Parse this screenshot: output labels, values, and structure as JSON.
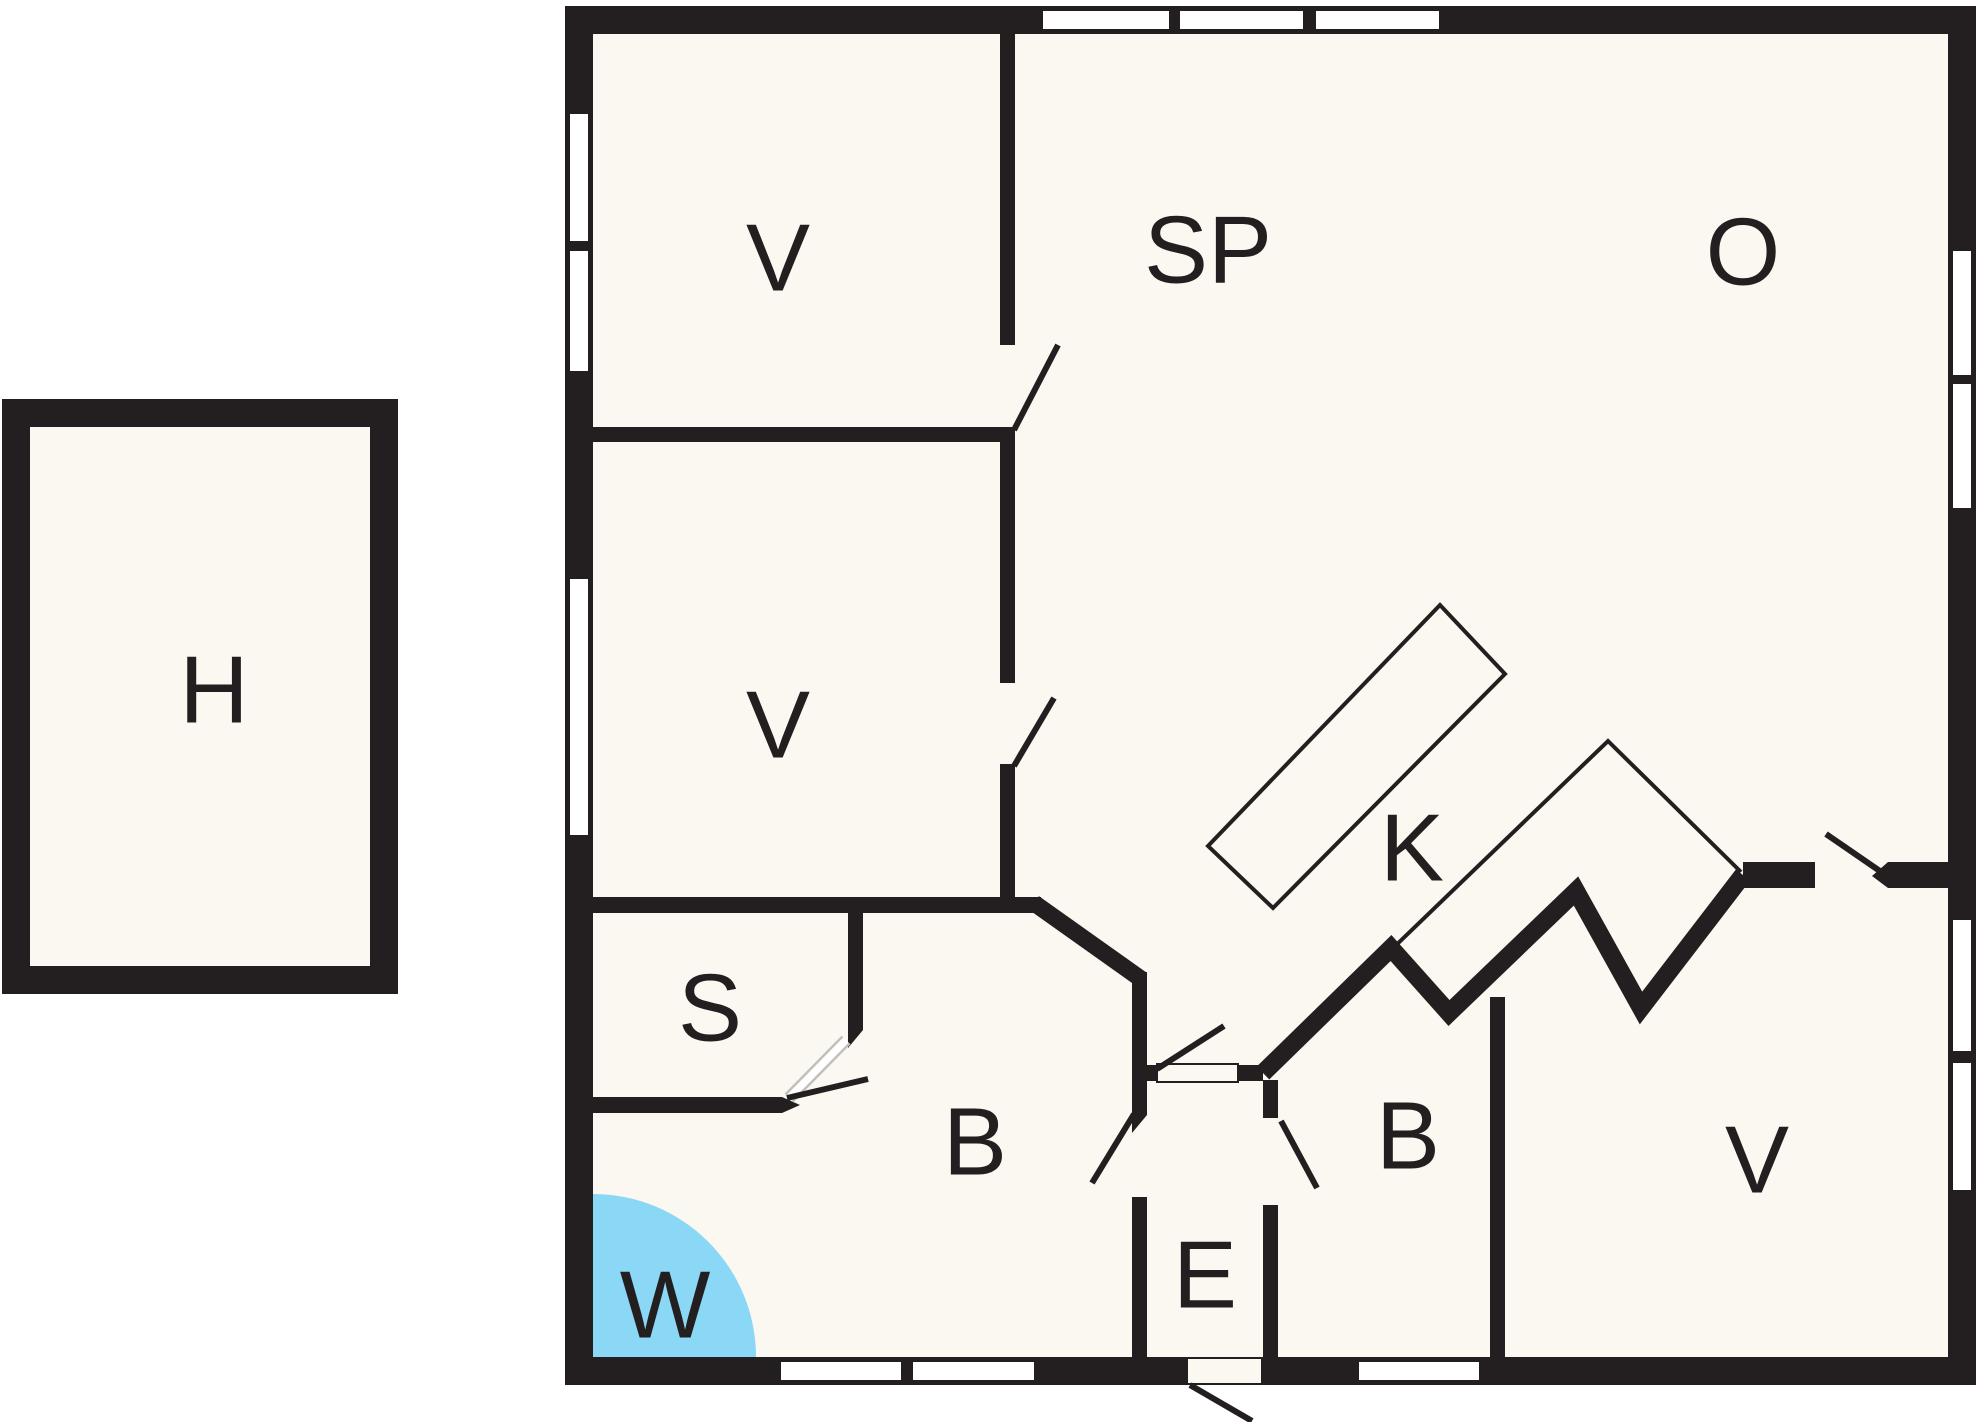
{
  "title": "floor-plan",
  "colors": {
    "wall": "#231f20",
    "floor": "#faf8f0",
    "page": "#ffffff",
    "water": "#8bd7f6",
    "thin_line": "#231f20",
    "panel_edge": "#c2c0ba"
  },
  "canvas": {
    "w": 1980,
    "h": 1422
  },
  "rooms": [
    {
      "id": "h",
      "label": "H",
      "x": 214,
      "y": 690
    },
    {
      "id": "v-top",
      "label": "V",
      "x": 778,
      "y": 258
    },
    {
      "id": "sp",
      "label": "SP",
      "x": 1208,
      "y": 250
    },
    {
      "id": "o",
      "label": "O",
      "x": 1743,
      "y": 252
    },
    {
      "id": "v-mid",
      "label": "V",
      "x": 778,
      "y": 725
    },
    {
      "id": "k",
      "label": "K",
      "x": 1412,
      "y": 848
    },
    {
      "id": "s",
      "label": "S",
      "x": 710,
      "y": 1008
    },
    {
      "id": "b-left",
      "label": "B",
      "x": 975,
      "y": 1142
    },
    {
      "id": "e",
      "label": "E",
      "x": 1205,
      "y": 1275
    },
    {
      "id": "b-right",
      "label": "B",
      "x": 1408,
      "y": 1136
    },
    {
      "id": "v-bottom",
      "label": "V",
      "x": 1757,
      "y": 1160
    },
    {
      "id": "w",
      "label": "W",
      "x": 665,
      "y": 1305
    }
  ],
  "plan": {
    "floors": [
      {
        "n": "annex-floor",
        "x": 2,
        "y": 399,
        "w": 396,
        "h": 595
      },
      {
        "n": "main-floor",
        "x": 565,
        "y": 6,
        "w": 1411,
        "h": 1379
      }
    ],
    "spa": {
      "cx": 593,
      "cy": 1357,
      "r": 163
    },
    "counters": {
      "island": "1208,846 1440,605 1505,674 1273,908",
      "run": "1391,950 1608,741 1741,872"
    },
    "walls_rects": [
      {
        "n": "annex-wall-top",
        "x": 2,
        "y": 399,
        "w": 396,
        "h": 28
      },
      {
        "n": "annex-wall-bottom",
        "x": 2,
        "y": 966,
        "w": 396,
        "h": 28
      },
      {
        "n": "annex-wall-left",
        "x": 2,
        "y": 399,
        "w": 28,
        "h": 595
      },
      {
        "n": "annex-wall-right",
        "x": 370,
        "y": 399,
        "w": 28,
        "h": 595
      },
      {
        "n": "main-wall-top",
        "x": 565,
        "y": 6,
        "w": 1411,
        "h": 28
      },
      {
        "n": "main-wall-bottom",
        "x": 565,
        "y": 1357,
        "w": 1411,
        "h": 28
      },
      {
        "n": "main-wall-left",
        "x": 565,
        "y": 6,
        "w": 28,
        "h": 1379
      },
      {
        "n": "main-wall-right",
        "x": 1948,
        "y": 6,
        "w": 28,
        "h": 1379
      },
      {
        "n": "wall-v-v-divider",
        "x": 593,
        "y": 427,
        "w": 422,
        "h": 15
      },
      {
        "n": "wall-divider-seg1",
        "x": 1000,
        "y": 34,
        "w": 15,
        "h": 311
      },
      {
        "n": "wall-divider-seg2",
        "x": 1000,
        "y": 428,
        "w": 15,
        "h": 255
      },
      {
        "n": "wall-divider-seg3",
        "x": 1000,
        "y": 764,
        "w": 15,
        "h": 149
      },
      {
        "n": "wall-s-top",
        "x": 593,
        "y": 897,
        "w": 448,
        "h": 16
      },
      {
        "n": "wall-e-left-seg1",
        "x": 1132,
        "y": 972,
        "w": 15,
        "h": 143
      },
      {
        "n": "wall-e-left-seg2",
        "x": 1132,
        "y": 1197,
        "w": 15,
        "h": 160
      },
      {
        "n": "wall-s-b-divider",
        "x": 848,
        "y": 913,
        "w": 15,
        "h": 117
      },
      {
        "n": "wall-s-bottom",
        "x": 593,
        "y": 1097,
        "w": 189,
        "h": 16
      },
      {
        "n": "wall-e-top-seg1",
        "x": 1147,
        "y": 1065,
        "w": 10,
        "h": 16
      },
      {
        "n": "wall-e-top-seg2",
        "x": 1238,
        "y": 1065,
        "w": 25,
        "h": 16
      },
      {
        "n": "wall-e-right-seg1",
        "x": 1263,
        "y": 1080,
        "w": 15,
        "h": 38
      },
      {
        "n": "wall-e-right-seg2",
        "x": 1263,
        "y": 1205,
        "w": 15,
        "h": 152
      },
      {
        "n": "wall-v-right-seg1",
        "x": 1743,
        "y": 862,
        "w": 72,
        "h": 26
      },
      {
        "n": "wall-v-right-seg2",
        "x": 1888,
        "y": 862,
        "w": 60,
        "h": 26
      },
      {
        "n": "wall-b-v-divider",
        "x": 1490,
        "y": 997,
        "w": 15,
        "h": 360
      }
    ],
    "walls_lines": [
      {
        "n": "wall-chamfer",
        "x1": 1034,
        "y1": 903,
        "x2": 1141,
        "y2": 979,
        "w": 17
      }
    ],
    "walls_zigzag": {
      "n": "wall-kitchen-zigzag",
      "points": "1263,1073 1391,948 1449,1013 1576,891 1641,1008 1743,875",
      "w": 18
    },
    "walls_polys": [
      {
        "n": "doorstop-s-divider",
        "points": "863,1030 848,1030 848,1048"
      },
      {
        "n": "doorstop-s-bottom",
        "points": "782,1097 800,1105 782,1113"
      },
      {
        "n": "doorstop-v-right",
        "points": "1888,862 1872,876 1888,888"
      },
      {
        "n": "doorstop-e-left",
        "points": "1132,1115 1147,1115 1132,1133"
      }
    ],
    "windows": [
      {
        "n": "window-left-1",
        "x": 569,
        "y": 113,
        "w": 20,
        "h": 129
      },
      {
        "n": "window-left-2",
        "x": 569,
        "y": 250,
        "w": 20,
        "h": 122
      },
      {
        "n": "window-left-3",
        "x": 569,
        "y": 578,
        "w": 20,
        "h": 258
      },
      {
        "n": "window-top-1",
        "x": 1042,
        "y": 10,
        "w": 128,
        "h": 20
      },
      {
        "n": "window-top-2",
        "x": 1179,
        "y": 10,
        "w": 125,
        "h": 20
      },
      {
        "n": "window-top-3",
        "x": 1315,
        "y": 10,
        "w": 125,
        "h": 20
      },
      {
        "n": "window-right-1",
        "x": 1952,
        "y": 250,
        "w": 20,
        "h": 126
      },
      {
        "n": "window-right-2",
        "x": 1952,
        "y": 383,
        "w": 20,
        "h": 126
      },
      {
        "n": "window-right-3",
        "x": 1952,
        "y": 919,
        "w": 20,
        "h": 133
      },
      {
        "n": "window-right-4",
        "x": 1952,
        "y": 1062,
        "w": 20,
        "h": 129
      },
      {
        "n": "window-bottom-1",
        "x": 780,
        "y": 1361,
        "w": 122,
        "h": 20
      },
      {
        "n": "window-bottom-2",
        "x": 912,
        "y": 1361,
        "w": 123,
        "h": 20
      },
      {
        "n": "window-bottom-3",
        "x": 1358,
        "y": 1361,
        "w": 122,
        "h": 20
      }
    ],
    "openings": [
      {
        "n": "opening-e-top",
        "x": 1157,
        "y": 1064,
        "w": 81,
        "h": 18
      },
      {
        "n": "opening-entry-door",
        "x": 1187,
        "y": 1358,
        "w": 75,
        "h": 26
      }
    ],
    "door_panel": {
      "n": "door-panel-s",
      "x1": 846,
      "y1": 1040,
      "x2": 789,
      "y2": 1098
    },
    "door_leaves": [
      {
        "n": "door-leaf-sp",
        "x1": 1014,
        "y1": 430,
        "x2": 1058,
        "y2": 345
      },
      {
        "n": "door-leaf-v-mid",
        "x1": 1014,
        "y1": 766,
        "x2": 1054,
        "y2": 698
      },
      {
        "n": "door-leaf-s",
        "x1": 787,
        "y1": 1098,
        "x2": 868,
        "y2": 1079
      },
      {
        "n": "door-leaf-b-left",
        "x1": 1134,
        "y1": 1114,
        "x2": 1092,
        "y2": 1183
      },
      {
        "n": "door-leaf-e-top",
        "x1": 1157,
        "y1": 1069,
        "x2": 1224,
        "y2": 1026
      },
      {
        "n": "door-leaf-b-right",
        "x1": 1281,
        "y1": 1121,
        "x2": 1317,
        "y2": 1188
      },
      {
        "n": "door-leaf-v-right",
        "x1": 1826,
        "y1": 834,
        "x2": 1890,
        "y2": 878
      },
      {
        "n": "door-leaf-entry",
        "x1": 1190,
        "y1": 1385,
        "x2": 1252,
        "y2": 1421
      }
    ]
  }
}
